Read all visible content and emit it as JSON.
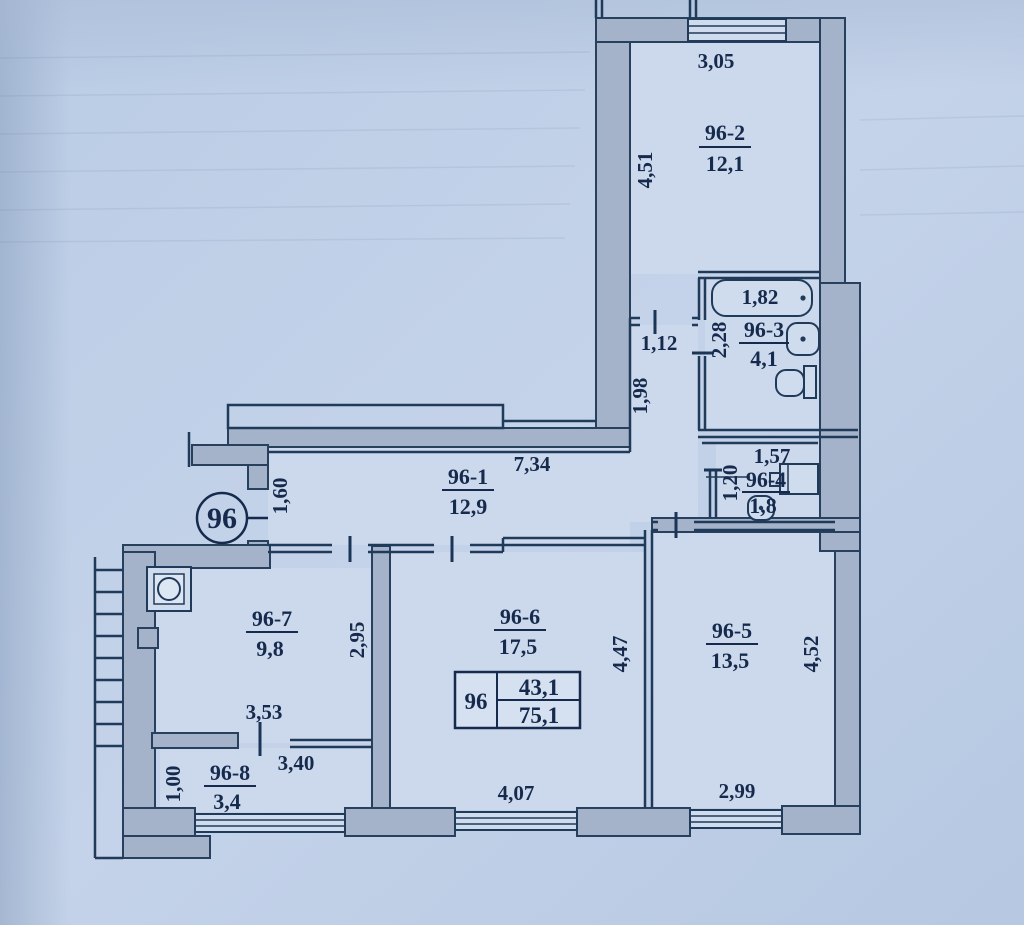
{
  "plan": {
    "unit_circle_label": "96",
    "area_table": {
      "unit": "96",
      "living_area": "43,1",
      "total_area": "75,1"
    },
    "rooms": {
      "r96_1": {
        "id": "96-1",
        "area": "12,9",
        "dim_width": "7,34",
        "dim_entry": "1,60",
        "dim_pass_width": "1,12",
        "dim_pass_len": "1,98"
      },
      "r96_2": {
        "id": "96-2",
        "area": "12,1",
        "dim_width": "3,05",
        "dim_height": "4,51"
      },
      "r96_3": {
        "id": "96-3",
        "area": "4,1",
        "dim_tub": "1,82",
        "dim_height": "2,28"
      },
      "r96_4": {
        "id": "96-4",
        "area": "1,8",
        "dim_width": "1,57",
        "dim_door": "1,20"
      },
      "r96_5": {
        "id": "96-5",
        "area": "13,5",
        "dim_width": "2,99",
        "dim_height": "4,52"
      },
      "r96_6": {
        "id": "96-6",
        "area": "17,5",
        "dim_width": "4,07",
        "dim_height": "4,47"
      },
      "r96_7": {
        "id": "96-7",
        "area": "9,8",
        "dim_width": "3,53",
        "dim_height": "2,95"
      },
      "r96_8": {
        "id": "96-8",
        "area": "3,4",
        "dim_width": "3,40",
        "dim_height": "1,00"
      }
    },
    "colors": {
      "paper": "#bccee6",
      "wall_fill": "#a4b3c9",
      "line": "#203a5a",
      "text": "#152a4c"
    }
  }
}
